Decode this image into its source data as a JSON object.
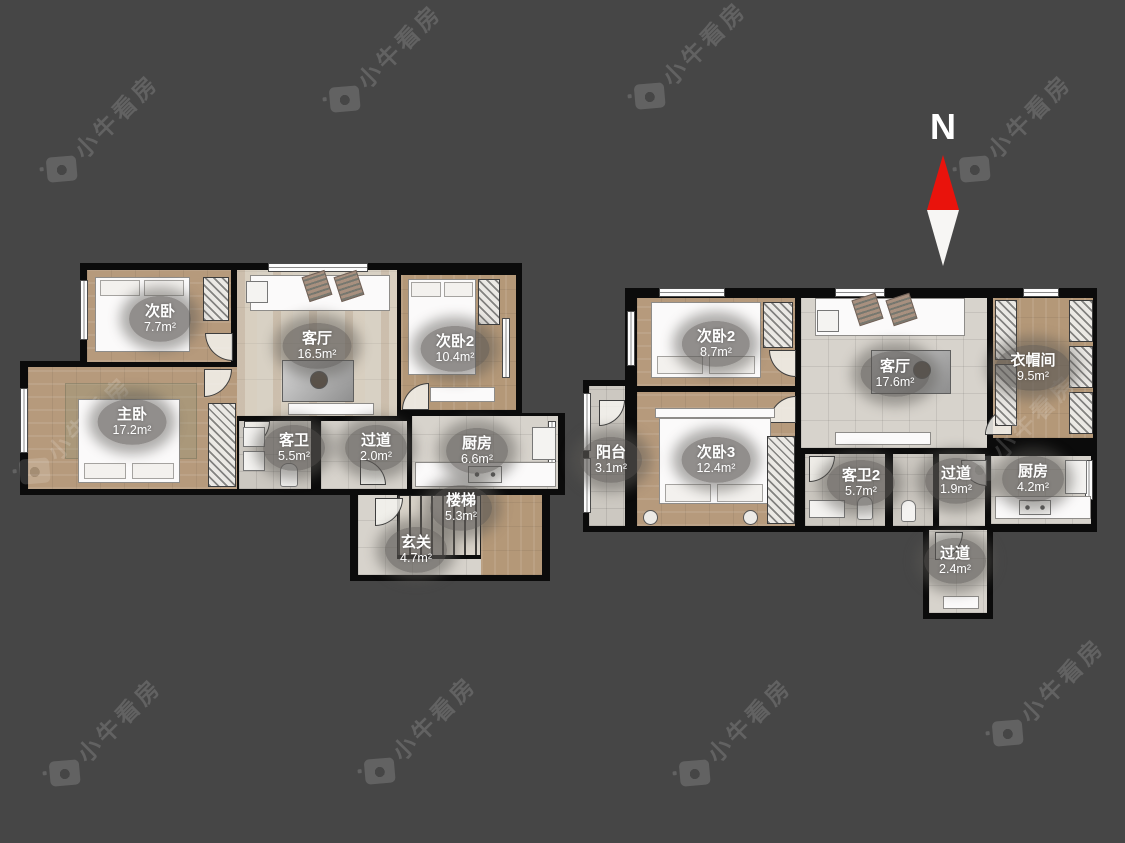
{
  "meta": {
    "background_color": "#464646",
    "wall_color": "#0b0b0b",
    "watermark_text": "小牛看房",
    "watermark_icon": "camera-icon",
    "north_label": "N",
    "north_arrow_red": "#e9130c"
  },
  "plans": [
    {
      "name": "plan-left-lower-level",
      "rooms": [
        {
          "label": "次卧",
          "area": "7.7m²"
        },
        {
          "label": "客厅",
          "area": "16.5m²"
        },
        {
          "label": "次卧2",
          "area": "10.4m²"
        },
        {
          "label": "主卧",
          "area": "17.2m²"
        },
        {
          "label": "客卫",
          "area": "5.5m²"
        },
        {
          "label": "过道",
          "area": "2.0m²"
        },
        {
          "label": "厨房",
          "area": "6.6m²"
        },
        {
          "label": "楼梯",
          "area": "5.3m²"
        },
        {
          "label": "玄关",
          "area": "4.7m²"
        }
      ]
    },
    {
      "name": "plan-right-upper-level",
      "rooms": [
        {
          "label": "次卧2",
          "area": "8.7m²"
        },
        {
          "label": "客厅",
          "area": "17.6m²"
        },
        {
          "label": "衣帽间",
          "area": "9.5m²"
        },
        {
          "label": "阳台",
          "area": "3.1m²"
        },
        {
          "label": "次卧3",
          "area": "12.4m²"
        },
        {
          "label": "客卫2",
          "area": "5.7m²"
        },
        {
          "label": "过道",
          "area": "1.9m²"
        },
        {
          "label": "厨房",
          "area": "4.2m²"
        },
        {
          "label": "过道",
          "area": "2.4m²"
        }
      ]
    }
  ]
}
